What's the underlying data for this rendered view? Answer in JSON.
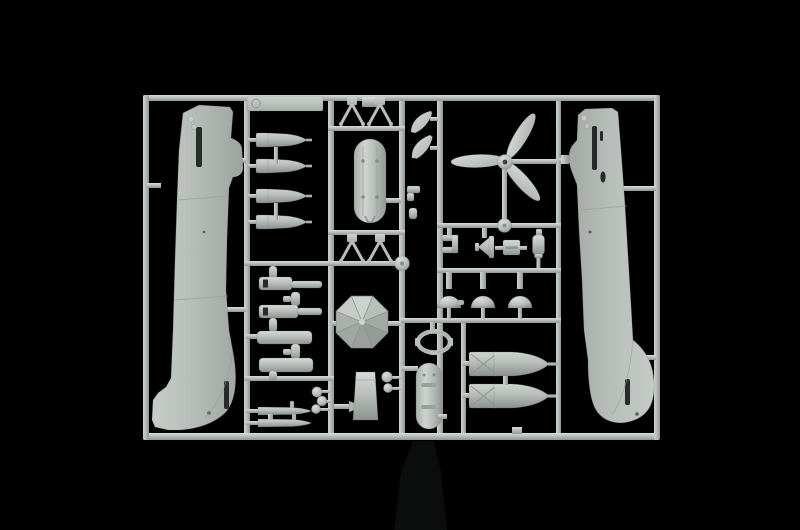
{
  "scene": {
    "type": "photograph",
    "description": "Light grey injection-moulded plastic model-kit sprue (parts tree) of a WWII single-engine aircraft kit photographed on a black background",
    "background_color": "#000000",
    "plastic_color": "#b6bcb8",
    "plastic_highlight": "#d7ddd8",
    "plastic_shadow": "#80867f",
    "slot_shadow_color": "#272b29"
  },
  "sprue": {
    "frame": {
      "left": 143,
      "top": 95,
      "right": 660,
      "bottom": 440,
      "rail_width_px": 6
    },
    "label_plate": {
      "mark": "small embossed circular stamp at left end of flat plate",
      "text": ""
    },
    "parts": [
      {
        "name": "fuselage-half-left",
        "desc": "left fuselage half, nose up, rudder pointing left at bottom",
        "count": 1
      },
      {
        "name": "fuselage-half-right",
        "desc": "right fuselage half, nose up, rudder pointing right at bottom",
        "count": 1
      },
      {
        "name": "small-bombs",
        "desc": "four small bombs with box tail fins, noses pointing right",
        "count": 4
      },
      {
        "name": "exhaust-stacks",
        "desc": "four horizontal cylindrical stacks with short vertical studs",
        "count": 4
      },
      {
        "name": "gun-pods",
        "desc": "two slender pointed underwing pods",
        "count": 2
      },
      {
        "name": "hub-caps",
        "desc": "small round caps in a diagonal cluster plus a pair near centre",
        "count": 5
      },
      {
        "name": "aerial-v-struts",
        "desc": "four V-shaped strut parts, two pairs",
        "count": 4
      },
      {
        "name": "drop-tank-large",
        "desc": "large oval drop tank with four filler dots and forked lower end",
        "count": 1
      },
      {
        "name": "drop-tank-small",
        "desc": "small oval drop tank with two horizontal slots",
        "count": 1
      },
      {
        "name": "faceted-dome",
        "desc": "octagonal faceted umbrella-like dome",
        "count": 1
      },
      {
        "name": "propeller",
        "desc": "three-blade propeller with hub",
        "count": 1
      },
      {
        "name": "dome-caps",
        "desc": "three hemispherical dome caps in a row",
        "count": 3
      },
      {
        "name": "intake-scoops",
        "desc": "two curved crescent scoops",
        "count": 2
      },
      {
        "name": "hatch-ring",
        "desc": "small oval open frame with nubs",
        "count": 1
      },
      {
        "name": "large-bombs",
        "desc": "two large bombs with box tail fins, noses pointing right",
        "count": 2
      },
      {
        "name": "flap-panel",
        "desc": "tapered rectangular panel",
        "count": 1
      },
      {
        "name": "small-fittings",
        "desc": "C-bracket, funnel cone, grooved block and bottle fitting in a row",
        "count": 4
      }
    ]
  }
}
